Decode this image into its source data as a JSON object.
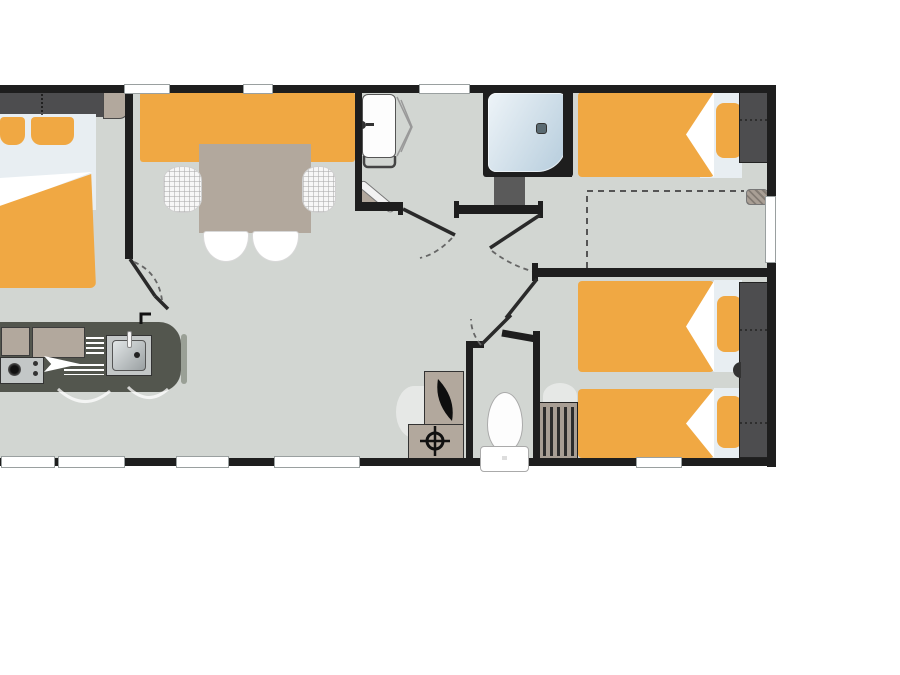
{
  "meta": {
    "title": "Mobile home floor plan",
    "description": "Top-down furnished 2D floor plan with three bedrooms, living-dining area, kitchen, shower room and WC. No text labels are rendered in the drawing.",
    "canvas": {
      "width": 900,
      "height": 675
    },
    "background": "#ffffff"
  },
  "colors": {
    "wall": "#1e1e1e",
    "floor": "#d2d6d2",
    "orange": "#f0a843",
    "taupe": "#b2a89d",
    "wardrobe": "#4d4d4f",
    "counter": "#53564e",
    "stainless": "#c3c7c7",
    "pale_bedding": "#e8eef2",
    "shower_light": "#eef4f8",
    "shower_dark": "#b5ccdc",
    "radiator": "#a89e94",
    "window_border": "#9aa0a0",
    "leaf": "#2a2a2a",
    "dash": "#666666",
    "white": "#ffffff"
  },
  "rooms": [
    {
      "name": "master-bedroom",
      "furniture": [
        "double-bed",
        "two-pillows",
        "wardrobe",
        "side-cabinet"
      ]
    },
    {
      "name": "living-dining",
      "furniture": [
        "bench-seat",
        "dining-table",
        "wicker-chair-left",
        "wicker-chair-right",
        "chair",
        "chair"
      ]
    },
    {
      "name": "kitchen",
      "furniture": [
        "worktop",
        "hob",
        "sink",
        "drainer",
        "wall-cabinets",
        "tap"
      ]
    },
    {
      "name": "shower-room",
      "furniture": [
        "washbasin",
        "mirror",
        "towel-rail",
        "shower-cubicle",
        "storage-column"
      ]
    },
    {
      "name": "wc",
      "furniture": [
        "toilet",
        "water-heater",
        "vent-box"
      ]
    },
    {
      "name": "bedroom-2",
      "furniture": [
        "single-bed",
        "pillow",
        "wardrobe",
        "optional-bed-zone-dashed",
        "wall-step"
      ]
    },
    {
      "name": "bedroom-3",
      "furniture": [
        "twin-bed",
        "twin-bed",
        "wardrobe",
        "radiator"
      ]
    }
  ],
  "openings": {
    "top_windows": 3,
    "bottom_windows": 5,
    "right_windows": 1,
    "interior_door_leaves": 6
  }
}
